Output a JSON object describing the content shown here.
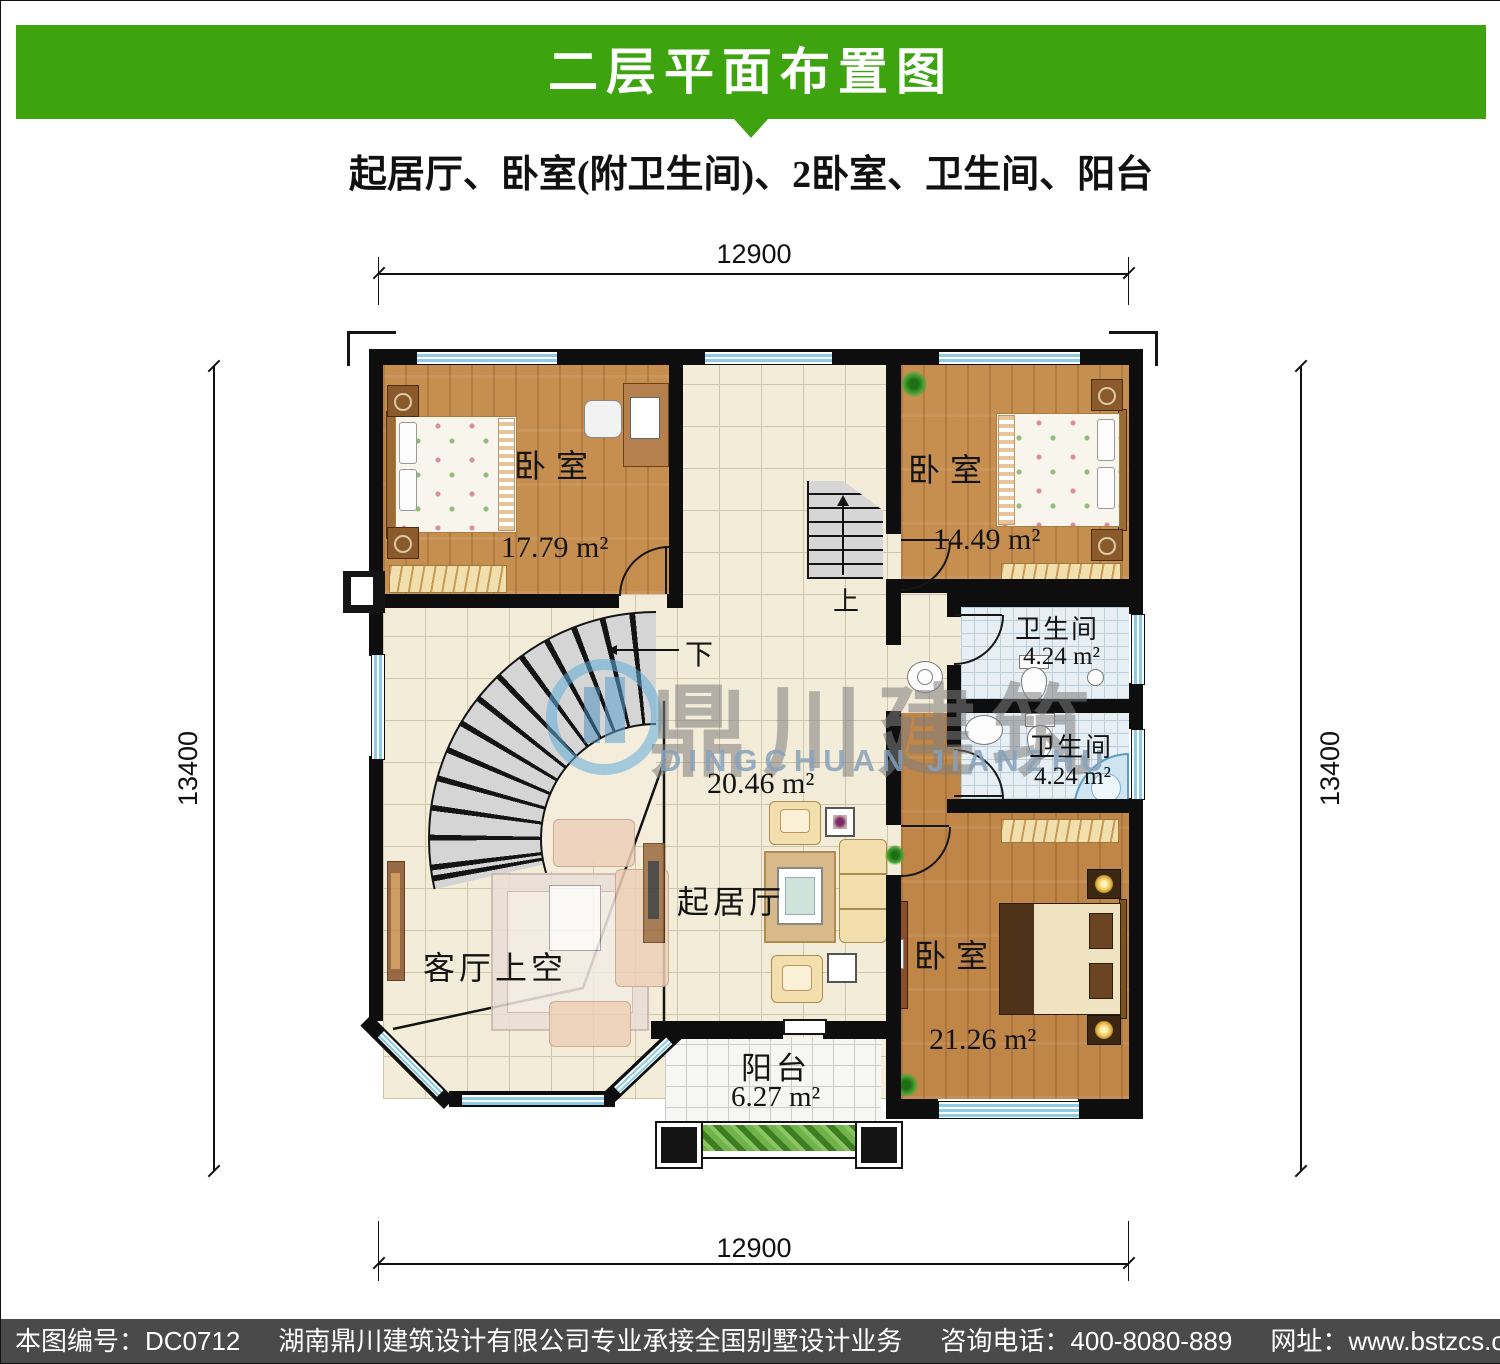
{
  "header": {
    "title": "二层平面布置图",
    "subtitle": "起居厅、卧室(附卫生间)、2卧室、卫生间、阳台"
  },
  "plan": {
    "dimensions": {
      "top": "12900",
      "bottom": "12900",
      "left": "13400",
      "right": "13400"
    },
    "rooms": {
      "bedroom_top_left": {
        "label": "卧室",
        "area": "17.79 m²"
      },
      "bedroom_top_right": {
        "label": "卧室",
        "area": "14.49 m²"
      },
      "bathroom_upper": {
        "label": "卫生间",
        "area": "4.24 m²"
      },
      "bathroom_lower": {
        "label": "卫生间",
        "area": "4.24 m²"
      },
      "bedroom_bottom_right": {
        "label": "卧室",
        "area": "21.26 m²"
      },
      "living_hall": {
        "label": "起居厅",
        "area": "20.46 m²"
      },
      "void_above_living": {
        "label": "客厅上空"
      },
      "balcony": {
        "label": "阳台",
        "area": "6.27 m²"
      }
    },
    "stairs": {
      "up": "上",
      "down": "下"
    }
  },
  "watermark": {
    "name": "鼎川建筑",
    "latin": "DINGCHUAN JIANZHU"
  },
  "footer": {
    "plan_no": "本图编号：DC0712",
    "company": "湖南鼎川建筑设计有限公司专业承接全国别墅设计业务",
    "phone": "咨询电话：400-8080-889",
    "website": "网址：www.bstzcs.com"
  },
  "colors": {
    "banner_green": "#3da410",
    "footer_gray": "#4a4a4a",
    "wall_black": "#0e0e0e",
    "window_blue": "#8ecbe4",
    "wood_floor": "#c68e4f",
    "hall_tile": "#f3ecd8",
    "bath_tile": "#e7eff4",
    "watermark_blue": "#5aaad8"
  }
}
